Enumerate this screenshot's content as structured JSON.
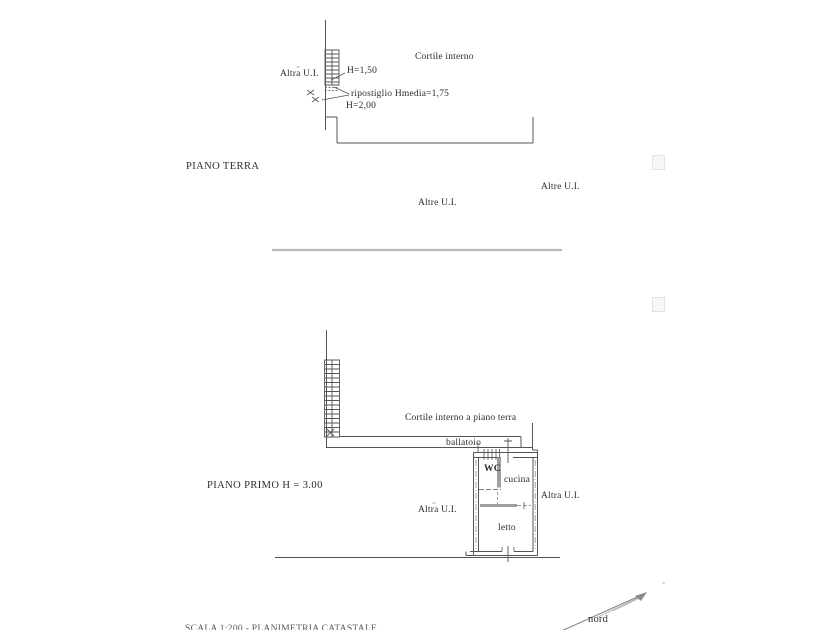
{
  "colors": {
    "line": "#555555",
    "wall_gray": "#9f9f9f",
    "separator": "#b9b9b9",
    "text": "#2b2b2b"
  },
  "ground_floor": {
    "title": "PIANO TERRA",
    "labels": {
      "altra_ui": "Altra U.I.",
      "cortile_interno": "Cortile interno"
    },
    "annotations": {
      "h_150": "H=1,50",
      "ripostiglio": "ripostiglio Hmedia=1,75",
      "h_200": "H=2,00"
    }
  },
  "between_floors": {
    "altre_ui_upper": "Altre U.I.",
    "altre_ui_lower": "Altre U.I."
  },
  "first_floor": {
    "title": "PIANO PRIMO H = 3.00",
    "labels": {
      "cortile_interno": "Cortile interno a piano terra",
      "ballatoio": "ballatoio",
      "wc": "WC",
      "cucina": "cucina",
      "letto": "letto",
      "altra_ui_right": "Altra U.I.",
      "altra_ui_left": "Altra U.I."
    }
  },
  "compass": {
    "north_label": "nord"
  },
  "footer": {
    "clipped_text": "SCALA 1:200 - PLANIMETRIA CATASTALE"
  }
}
